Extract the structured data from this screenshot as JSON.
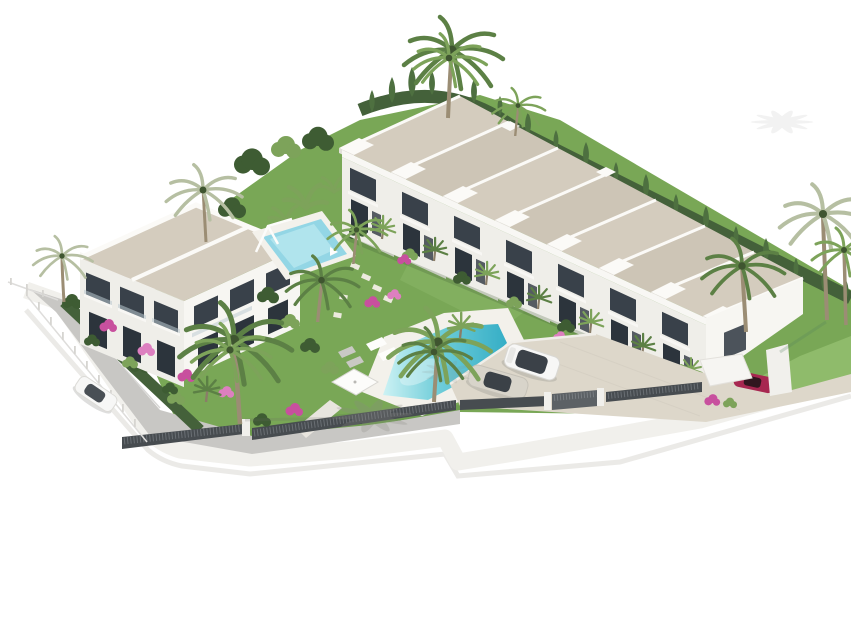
{
  "scene": {
    "title": "Aerial 3D render of a new-build townhouse development",
    "description": "Computer-generated aerial rendering on a white background showing a Mediterranean residential complex: a row of seven white townhouses with beige flat roofs backed by a cypress hedge, a two-storey white apartment block with bougainvillea, a small children's pool, a large turquoise communal pool with sun loungers and a square parasol, landscaped gardens with many palm trees, a grey access road with a parked white car, a beige parking court with a white SUV and a silver sedan, a carport with a red car, all enclosed by a curved white boundary wall topped with dark slatted fencing."
  },
  "counts": {
    "townhouse_units": 7,
    "apartment_blocks": 1,
    "pools": 2,
    "cars": 4,
    "tall_palm_trees": 10
  },
  "objects": {
    "townhouse_row": "row of seven terraced townhouses",
    "apartment_block": "two-storey apartment building",
    "main_pool": "large communal swimming pool",
    "kids_pool": "small children's pool with pergola",
    "parking_court": "paved parking area",
    "access_road": "grey access road",
    "boundary_wall": "white boundary wall with dark slat fence",
    "carport": "white carport with red car"
  },
  "colors": {
    "roof": "#d4ccbe",
    "roof_alt": "#cdc5b6",
    "ridge": "#fbfaf7",
    "wall": "#efeee9",
    "wall_bright": "#f7f6f2",
    "wall_shade": "#e2e0da",
    "fascia": "#f8f7f4",
    "window": "#39414a",
    "window_deep": "#2c343c",
    "glass": "#b9c8cf",
    "grass": "#79a756",
    "grass_light": "#8fbb6b",
    "grass_dark": "#5c8a41",
    "hedge": "#44613a",
    "cypress": "#4e7040",
    "foliage": "#3e5c33",
    "palm": "#5c8045",
    "palm_light": "#7da35a",
    "palm_pale": "#b6bfa2",
    "trunk": "#9b8d74",
    "pool_deep": "#35aec6",
    "pool_light": "#c9f1f3",
    "pool_small": "#93d6e5",
    "deck": "#f3f1eb",
    "road": "#c8c7c4",
    "pavement": "#ddd7ca",
    "pavement_light": "#e7e1d5",
    "fence": "#474c50",
    "fence_light": "#878d91",
    "wall_white": "#f1f0ec",
    "flower": "#c8509e",
    "flower_light": "#dd7fc0",
    "car_white": "#f7f7f6",
    "car_silver": "#d8d4ca",
    "car_red": "#a72750",
    "car_glass": "#2a3138",
    "shadow": "#8a8a84"
  }
}
